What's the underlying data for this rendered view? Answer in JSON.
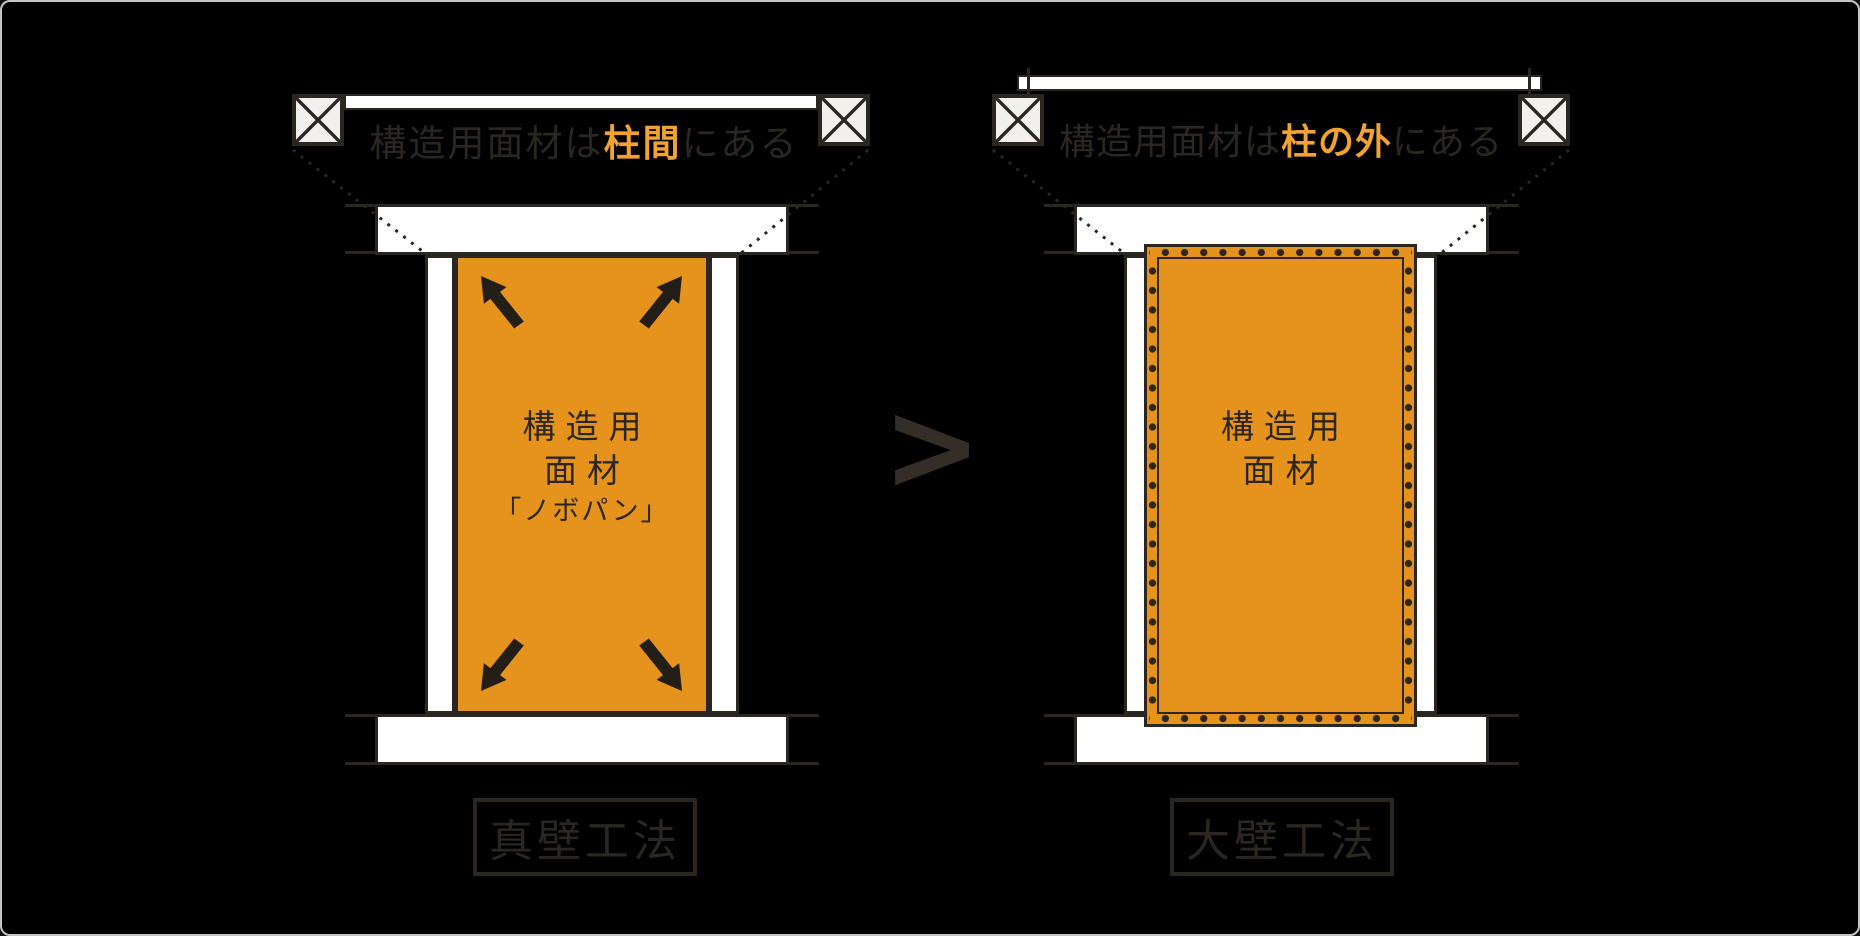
{
  "colors": {
    "background": "#000000",
    "frame_border": "#c6c6c6",
    "ink": "#2c2620",
    "panel_orange": "#e6931e",
    "accent_orange": "#f0a233",
    "beam_white": "#ffffff",
    "post_fill": "#f1f0ed"
  },
  "left_diagram": {
    "title_prefix": "構造用面材は",
    "title_highlight": "柱間",
    "title_suffix": "にある",
    "panel_line1": "構造用",
    "panel_line2": "面材",
    "panel_line3": "「ノボパン」",
    "caption": "真壁工法"
  },
  "right_diagram": {
    "title_prefix": "構造用面材は",
    "title_highlight": "柱の外",
    "title_suffix": "にある",
    "panel_line1": "構造用",
    "panel_line2": "面材",
    "caption": "大壁工法"
  },
  "comparison_symbol": ">"
}
